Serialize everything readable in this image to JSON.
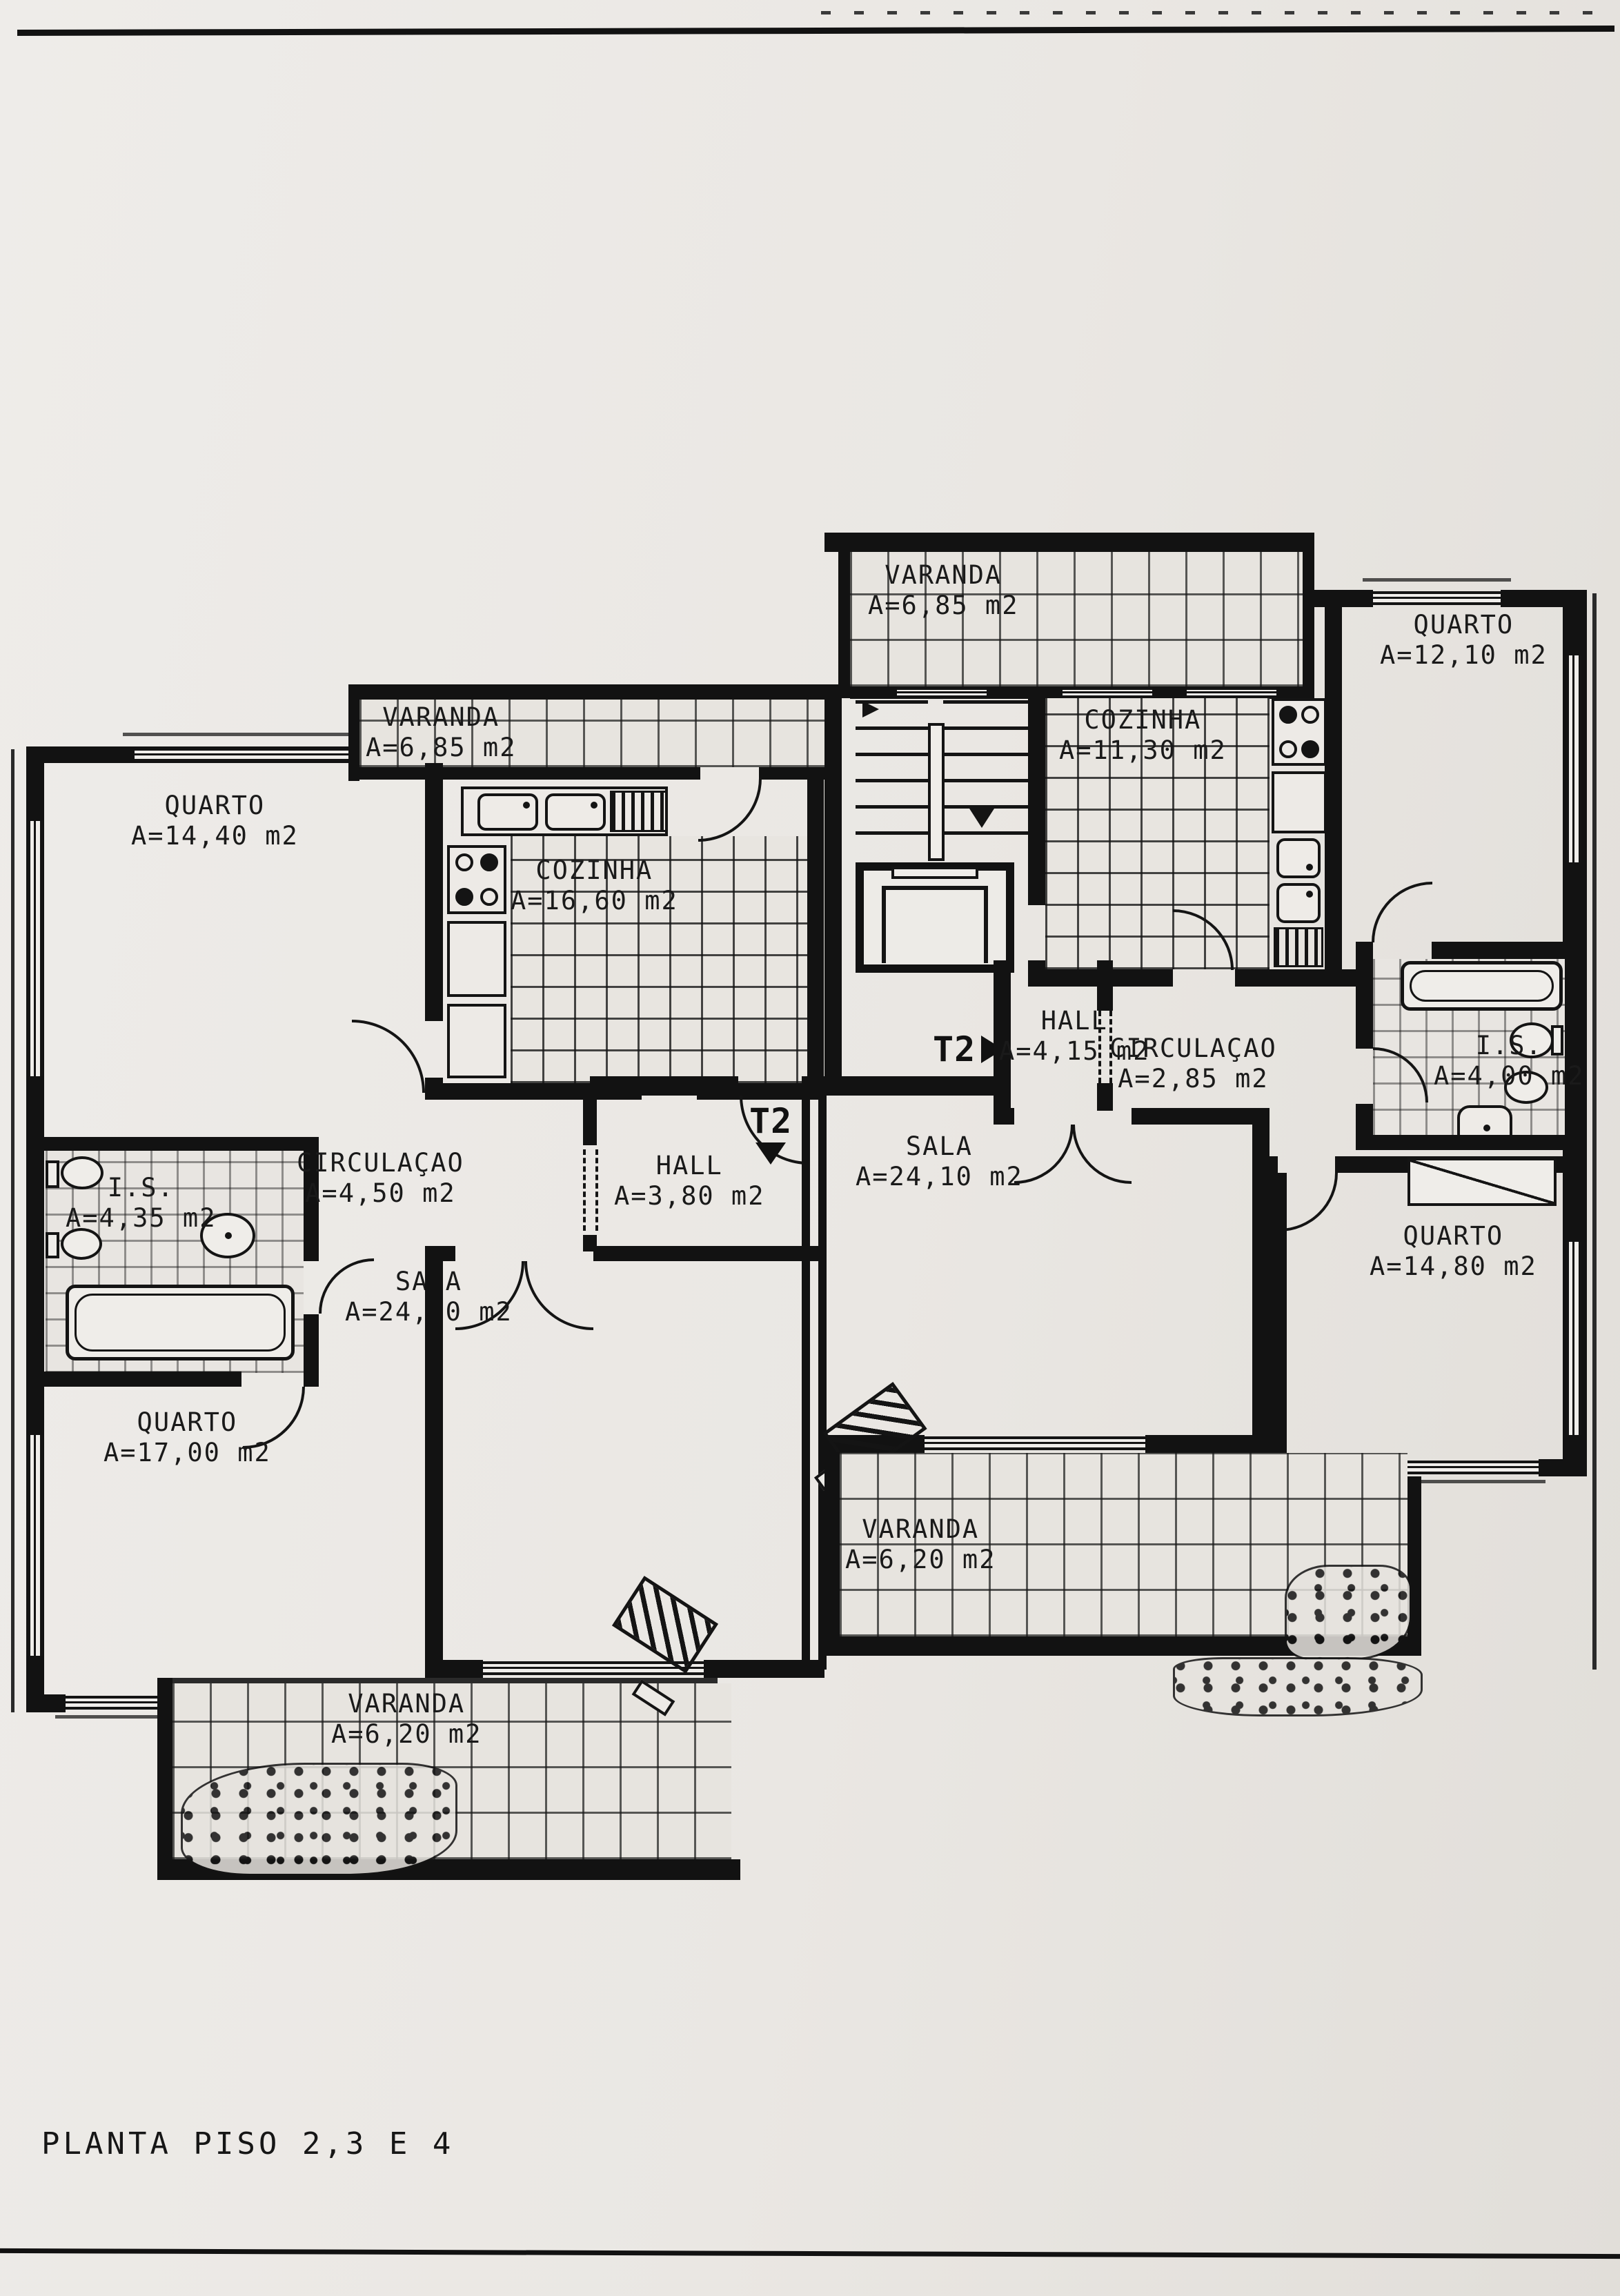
{
  "page": {
    "title": "PLANTA PISO 2,3 E 4"
  },
  "units": {
    "left_marker": "T2",
    "right_marker": "T2"
  },
  "rooms": {
    "varanda_top": {
      "name": "VARANDA",
      "area": "A=6,85 m2"
    },
    "varanda_left": {
      "name": "VARANDA",
      "area": "A=6,85 m2"
    },
    "quarto_top_right": {
      "name": "QUARTO",
      "area": "A=12,10 m2"
    },
    "cozinha_right": {
      "name": "COZINHA",
      "area": "A=11,30 m2"
    },
    "quarto_top_left": {
      "name": "QUARTO",
      "area": "A=14,40 m2"
    },
    "cozinha_left": {
      "name": "COZINHA",
      "area": "A=16,60 m2"
    },
    "hall_right": {
      "name": "HALL",
      "area": "A=4,15 m2"
    },
    "circulacao_right": {
      "name": "CIRCULAÇAO",
      "area": "A=2,85 m2"
    },
    "is_right": {
      "name": "I.S.",
      "area": "A=4,00 m2"
    },
    "circulacao_left": {
      "name": "CIRCULAÇAO",
      "area": "A=4,50 m2"
    },
    "hall_left": {
      "name": "HALL",
      "area": "A=3,80 m2"
    },
    "sala_right": {
      "name": "SALA",
      "area": "A=24,10 m2"
    },
    "is_left": {
      "name": "I.S.",
      "area": "A=4,35 m2"
    },
    "sala_left": {
      "name": "SALA",
      "area": "A=24,80 m2"
    },
    "quarto_bottom_left": {
      "name": "QUARTO",
      "area": "A=17,00 m2"
    },
    "quarto_bottom_right": {
      "name": "QUARTO",
      "area": "A=14,80 m2"
    },
    "varanda_bottom_mid": {
      "name": "VARANDA",
      "area": "A=6,20 m2"
    },
    "varanda_bottom_left": {
      "name": "VARANDA",
      "area": "A=6,20 m2"
    }
  }
}
